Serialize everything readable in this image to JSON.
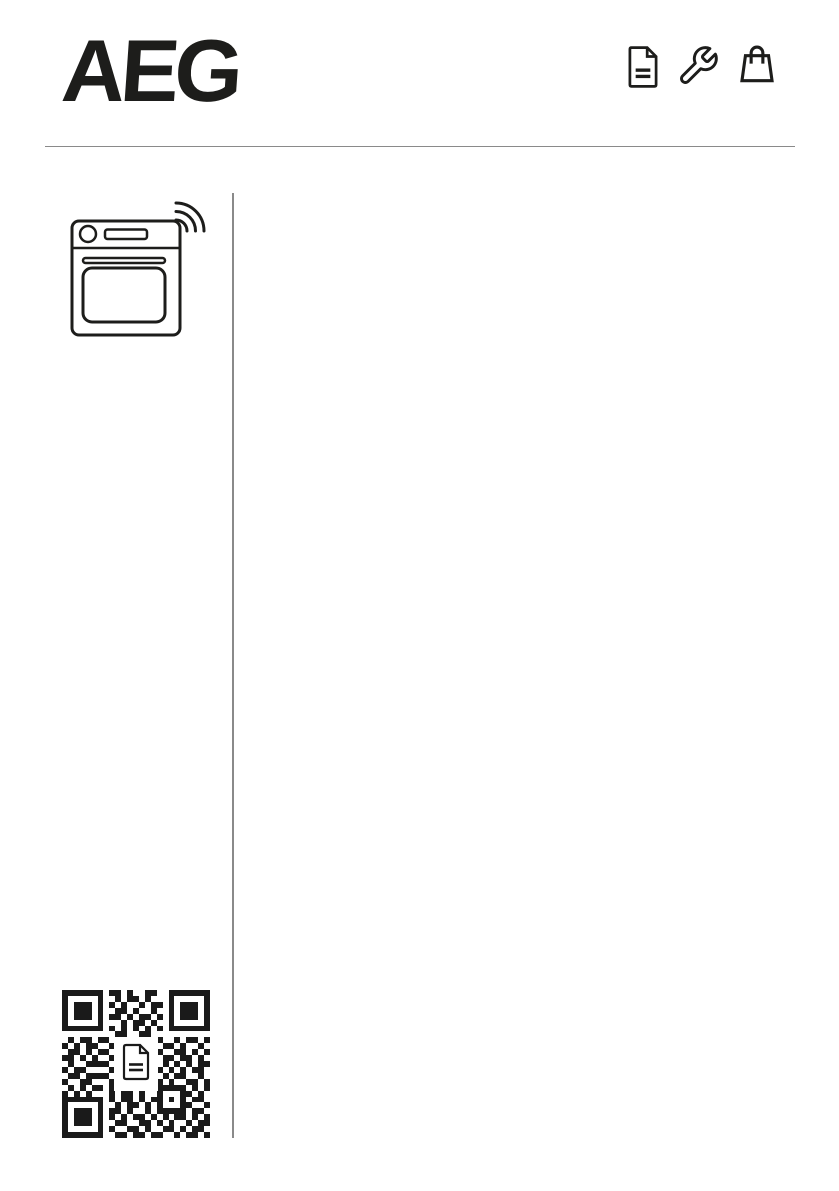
{
  "page": {
    "background": "#ffffff",
    "width": 839,
    "height": 1191
  },
  "header": {
    "brand": "AEG",
    "toolbar_icons": [
      "document-icon",
      "wrench-icon",
      "shopping-bag-icon"
    ]
  },
  "sidebar": {
    "appliance_icon": "oven-with-wifi-icon",
    "qr_code": {
      "size": 25,
      "center_icon": "document-icon",
      "modules": [
        "1111111011010011001111111",
        "1000001001011010001000001",
        "1011101010100101101011101",
        "1011101001101001001011101",
        "1011101011010110101011101",
        "1000001000101101001000001",
        "1111111010101010101111111",
        "0000000001100110000000000",
        "0101101101100101100101101",
        "1010110010111010011010010",
        "0110101101010110100110101",
        "1101010011010011011011010",
        "0100111100101101010101011",
        "1011000010110100101010110",
        "0110111101001011010110010",
        "1001100010101100101001101",
        "0101011011010110111110101",
        "1010100010110100100011010",
        "1111111010110101101010110",
        "1000001001011010100011001",
        "1011101011010010111110110",
        "1011101010101101010110101",
        "1011101001100110101001011",
        "1000001010011010011010110",
        "1111111001101101100101101"
      ]
    }
  },
  "colors": {
    "ink": "#1d1d1b",
    "divider": "#8a8a8a",
    "qr_dark": "#1a1a1a"
  }
}
